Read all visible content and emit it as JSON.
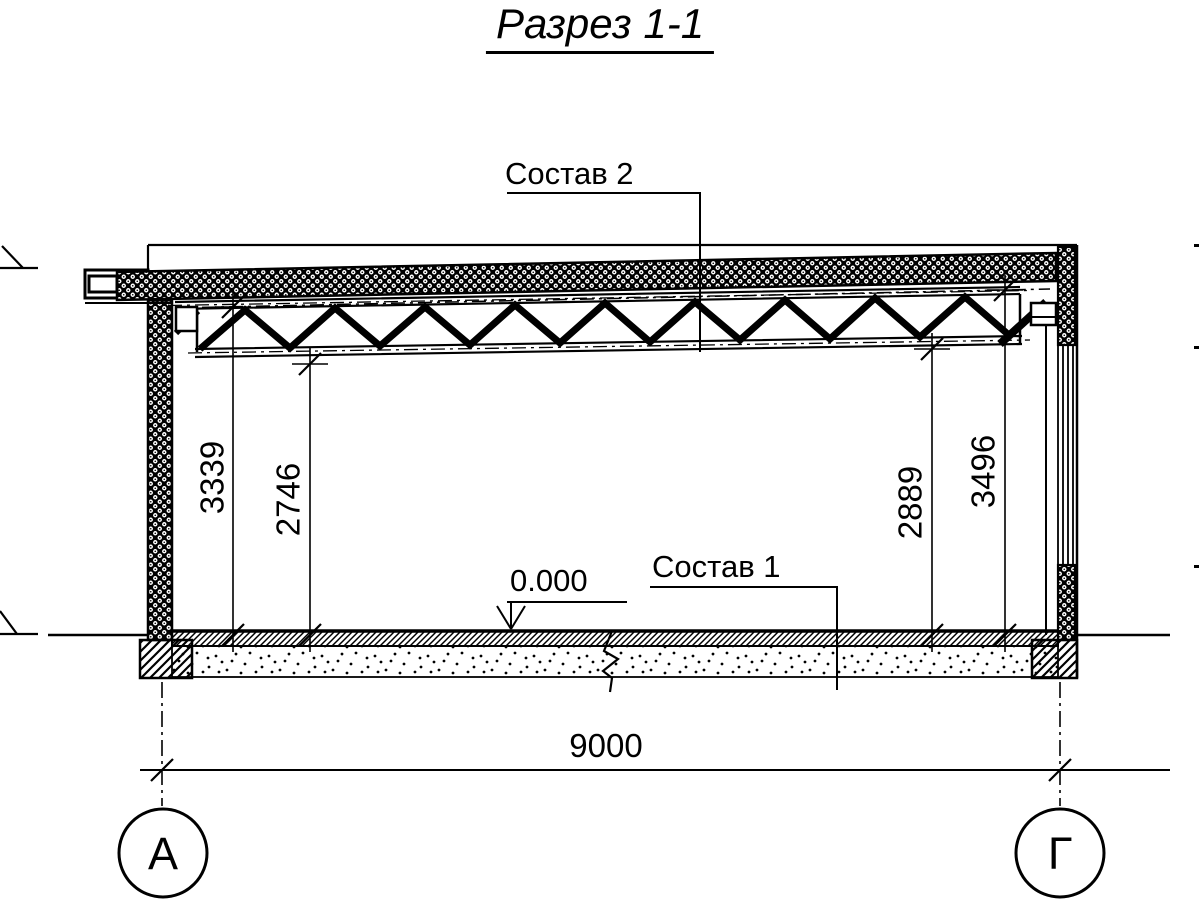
{
  "title": "Разрез 1-1",
  "labels": {
    "roof_composition": "Состав 2",
    "floor_composition": "Состав 1",
    "floor_level": "0.000"
  },
  "dimensions": {
    "left_floor_to_deck": "3339",
    "left_floor_to_truss": "2746",
    "right_floor_to_truss": "2889",
    "right_floor_to_deck": "3496",
    "span": "9000"
  },
  "axes": {
    "left": "А",
    "right": "Г"
  },
  "colors": {
    "line": "#000000",
    "background": "#ffffff"
  }
}
